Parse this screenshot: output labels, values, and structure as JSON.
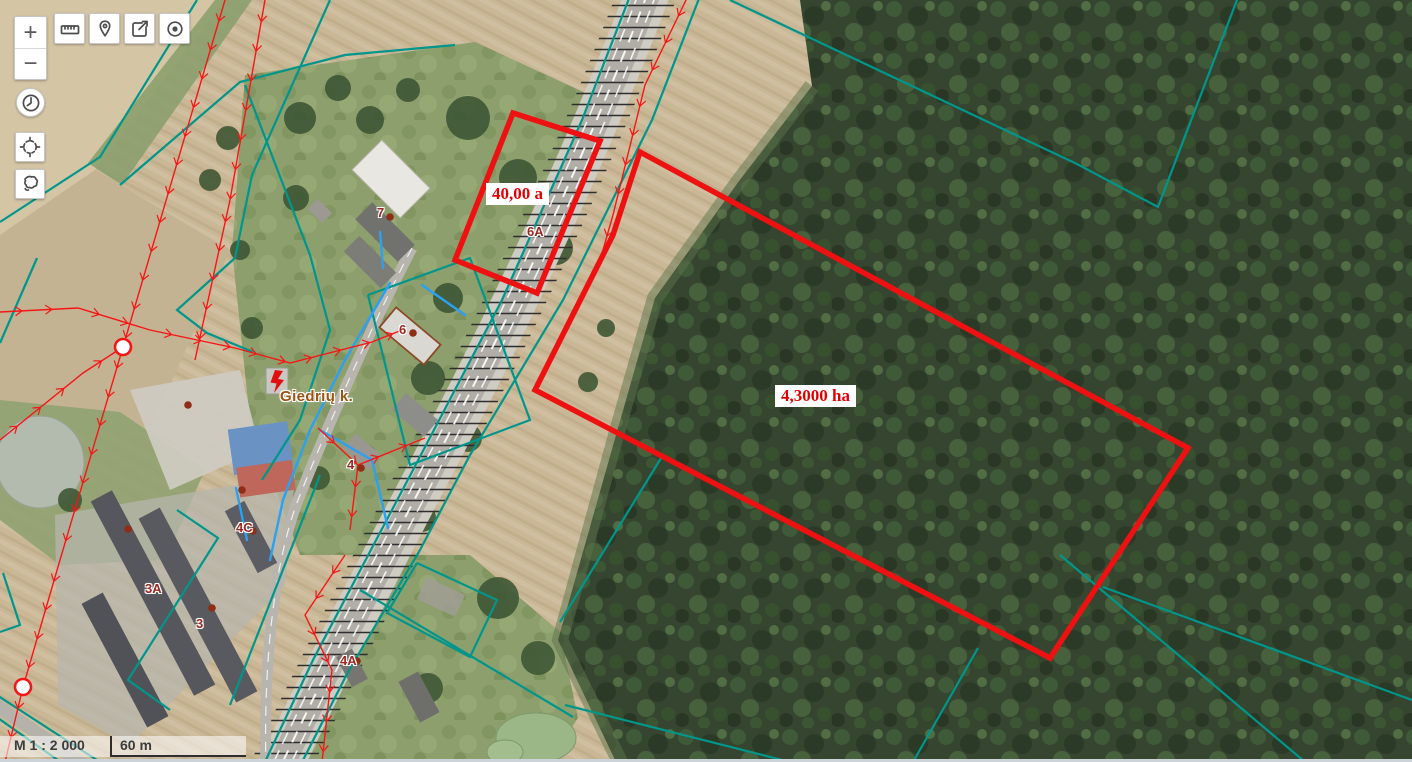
{
  "toolbar": {
    "zoom_in": "+",
    "zoom_out": "−",
    "buttons": [
      {
        "id": "measure",
        "icon": "ruler-icon"
      },
      {
        "id": "marker",
        "icon": "map-pin-icon"
      },
      {
        "id": "share",
        "icon": "share-icon"
      },
      {
        "id": "target",
        "icon": "target-icon"
      },
      {
        "id": "history",
        "icon": "clock-icon"
      },
      {
        "id": "locate",
        "icon": "crosshair-icon"
      },
      {
        "id": "lasso",
        "icon": "lasso-icon"
      }
    ]
  },
  "scalebar": {
    "scale_text": "M 1 : 2 000",
    "segment_label": "60 m"
  },
  "map": {
    "place_label": {
      "text": "Giedrių k.",
      "x": 280,
      "y": 388
    },
    "parcel_labels": [
      {
        "text": "40,00 a",
        "x": 486,
        "y": 183
      },
      {
        "text": "4,3000 ha",
        "x": 775,
        "y": 385
      }
    ],
    "address_labels": [
      {
        "text": "6A",
        "x": 527,
        "y": 224
      },
      {
        "text": "6",
        "x": 399,
        "y": 322
      },
      {
        "text": "7",
        "x": 377,
        "y": 205
      },
      {
        "text": "4",
        "x": 347,
        "y": 457
      },
      {
        "text": "4C",
        "x": 236,
        "y": 520
      },
      {
        "text": "3A",
        "x": 145,
        "y": 581
      },
      {
        "text": "3",
        "x": 196,
        "y": 616
      },
      {
        "text": "4A",
        "x": 340,
        "y": 653
      }
    ],
    "address_points": [
      [
        413,
        333
      ],
      [
        390,
        217
      ],
      [
        361,
        468
      ],
      [
        253,
        531
      ],
      [
        128,
        529
      ],
      [
        212,
        608
      ],
      [
        357,
        661
      ],
      [
        188,
        405
      ],
      [
        242,
        490
      ]
    ],
    "line_nodes": [
      [
        123,
        347
      ],
      [
        23,
        687
      ]
    ],
    "colors": {
      "parcel_boundary": "#ee1111",
      "parcel_label_text": "#e30000",
      "cadastral_line": "#00968b",
      "power_line": "#f51616",
      "water_line": "#2aa1f2",
      "address_text": "#9b2823",
      "address_point": "#8f2d16",
      "place_text": "#9c5310",
      "scale_text": "#3c3c3c"
    }
  }
}
